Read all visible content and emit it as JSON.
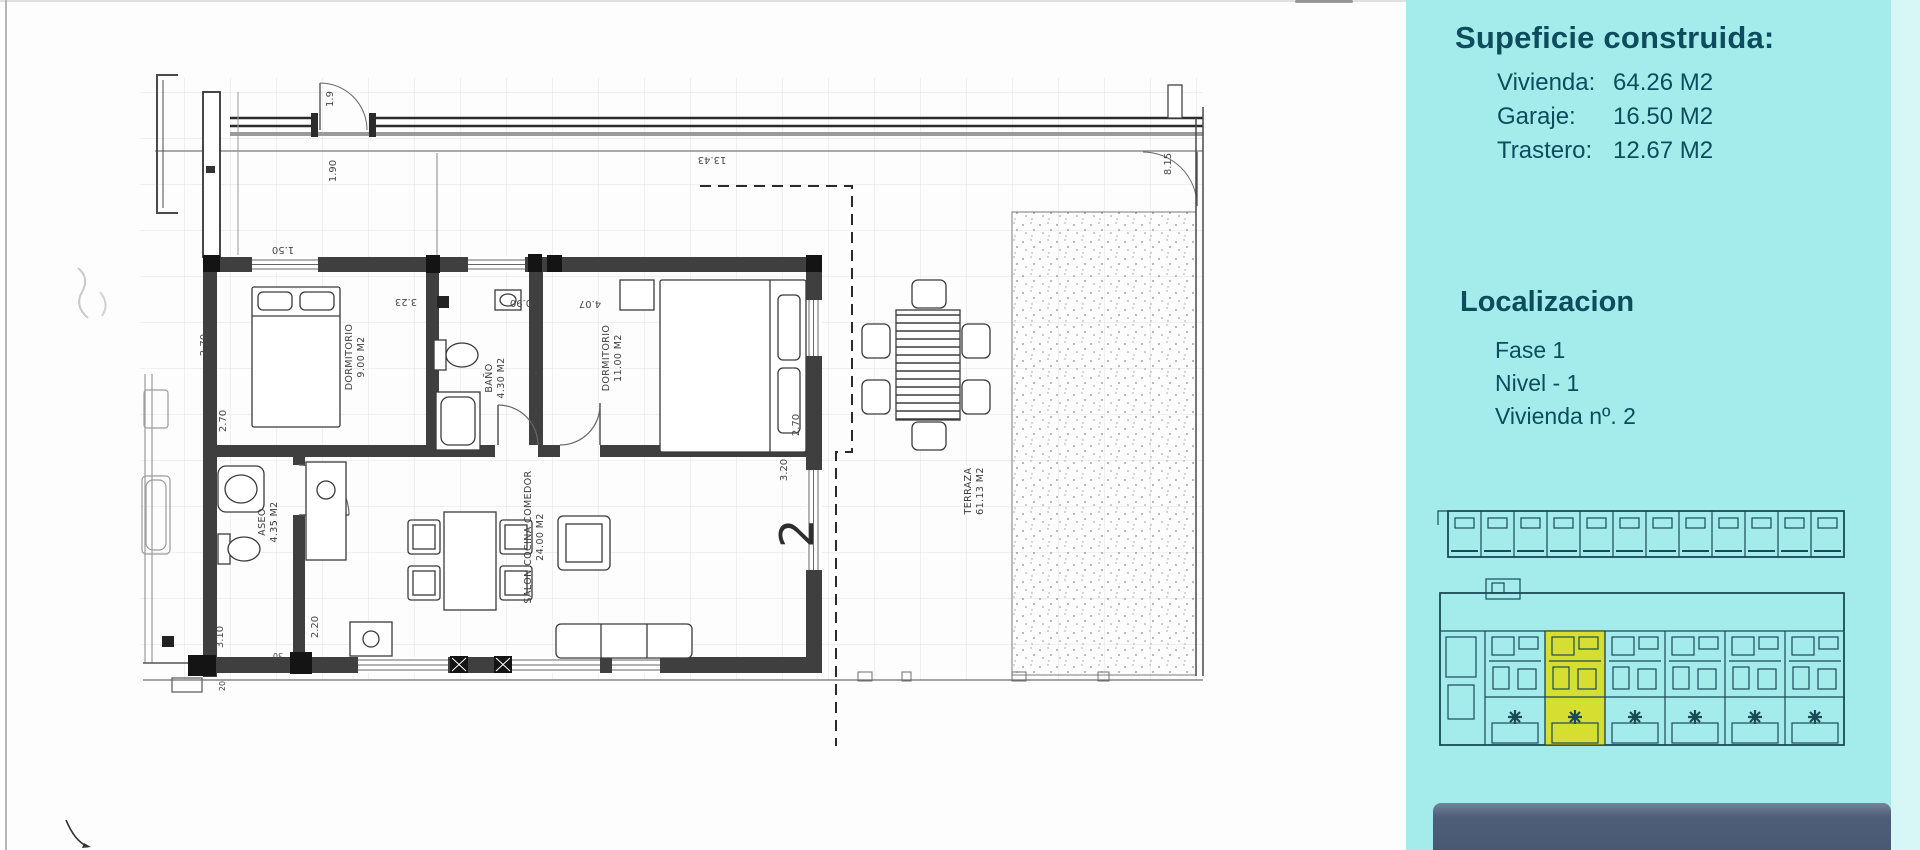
{
  "sidebar": {
    "bg_color": "#a4ecec",
    "text_color": "#0d4c5c",
    "surface_title": "Supeficie construida:",
    "surfaces": [
      {
        "label": "Vivienda:",
        "value": "64.26 M2"
      },
      {
        "label": "Garaje:",
        "value": "16.50 M2"
      },
      {
        "label": "Trastero:",
        "value": "12.67 M2"
      }
    ],
    "location_title": "Localizacion",
    "location_lines": [
      "Fase 1",
      "Nivel - 1",
      "Vivienda nº. 2"
    ],
    "minimap_highlight_color": "#d6df31",
    "footer_bar_color": "#4e5d78"
  },
  "plan": {
    "unit_number": "2",
    "rooms": [
      {
        "name": "DORMITORIO",
        "area": "9.00 M2"
      },
      {
        "name": "BAÑO",
        "area": "4.30 M2"
      },
      {
        "name": "DORMITORIO",
        "area": "11.00 M2"
      },
      {
        "name": "ASEO",
        "area": "4.35 M2"
      },
      {
        "name": "SALON COCINA COMEDOR",
        "area": "24.00 M2"
      },
      {
        "name": "TERRAZA",
        "area": "61.13 M2"
      }
    ],
    "dims": {
      "top": "13.43",
      "right": "8.15",
      "door": "1.50",
      "entry": "1.9",
      "entry2": "1.90",
      "dorm1_w": "3.23",
      "bano_w": "0.90",
      "dorm2_w": "4.07",
      "dorm1_h": "2.70",
      "aseo_h": "2.70",
      "aseo_v": "3.10",
      "kitchen": "2.20",
      "terr_a": "2.70",
      "terr_b": "3.20",
      "wall_a": "20",
      "wall_b": "30"
    }
  }
}
